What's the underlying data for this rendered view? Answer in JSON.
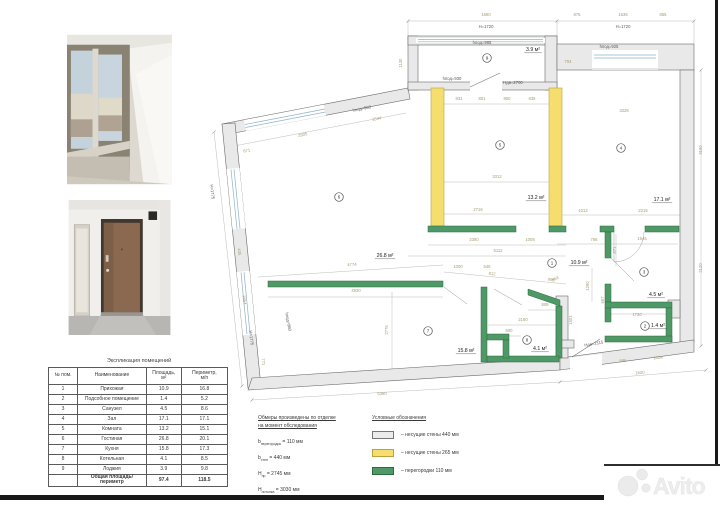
{
  "table": {
    "title": "Экспликация помещений",
    "headers": [
      "№ пом.",
      "Наименование",
      "Площадь,\nм²",
      "Периметр,\nм/п"
    ],
    "rows": [
      [
        "1",
        "Прихожая",
        "10.9",
        "16.8"
      ],
      [
        "2",
        "Подсобное помещение",
        "1.4",
        "5.2"
      ],
      [
        "3",
        "Санузел",
        "4.5",
        "8.6"
      ],
      [
        "4",
        "Зал",
        "17.1",
        "17.1"
      ],
      [
        "5",
        "Комната",
        "13.2",
        "15.1"
      ],
      [
        "6",
        "Гостиная",
        "26.8",
        "20.1"
      ],
      [
        "7",
        "Кухня",
        "15.8",
        "17.3"
      ],
      [
        "8",
        "Котельная",
        "4.1",
        "8.5"
      ],
      [
        "9",
        "Лоджия",
        "3.9",
        "9.8"
      ]
    ],
    "total": {
      "label": "Общая площадь/периметр",
      "area": "97.4",
      "perimeter": "118.5"
    }
  },
  "notes": {
    "line1": "Обмеры произведены по отделке",
    "line2": "на момент обследования",
    "items": [
      {
        "sym": "b",
        "sub": "перегородок",
        "val": "= 110 мм"
      },
      {
        "sym": "b",
        "sub": "стен",
        "val": "= 440 мм"
      },
      {
        "sym": "H",
        "sub": "пр",
        "val": "= 2745 мм"
      },
      {
        "sym": "H",
        "sub": "потолка",
        "val": "= 3030 мм"
      }
    ]
  },
  "legend": {
    "title": "Условные обозначения",
    "items": [
      {
        "color": "#ececec",
        "border": "#777777",
        "label": "– несущие стены 440 мм"
      },
      {
        "color": "#f5dd6e",
        "border": "#b9a33e",
        "label": "– несущие стены 265 мм"
      },
      {
        "color": "#4f9966",
        "border": "#2d6a43",
        "label": "– перегородки 110 мм"
      }
    ]
  },
  "plan": {
    "wall_colors": {
      "bearing_440": "#e9e9e9",
      "bearing_265": "#f5dd6e",
      "partition_110": "#4f9966"
    },
    "rooms": [
      {
        "num": "1",
        "cx": 552,
        "cy": 263,
        "area": "10.9 м²",
        "lx": 579,
        "ly": 264
      },
      {
        "num": "2",
        "cx": 645,
        "cy": 326,
        "area": "1.4 м²",
        "lx": 658,
        "ly": 327
      },
      {
        "num": "3",
        "cx": 644,
        "cy": 272,
        "area": "4.5 м²",
        "lx": 656,
        "ly": 296
      },
      {
        "num": "4",
        "cx": 621,
        "cy": 148,
        "area": "17.1 м²",
        "lx": 662,
        "ly": 201
      },
      {
        "num": "5",
        "cx": 500,
        "cy": 145,
        "area": "13.2 м²",
        "lx": 536,
        "ly": 199
      },
      {
        "num": "6",
        "cx": 339,
        "cy": 197,
        "area": "26.8 м²",
        "lx": 385,
        "ly": 257
      },
      {
        "num": "7",
        "cx": 428,
        "cy": 331,
        "area": "15.8 м²",
        "lx": 466,
        "ly": 352
      },
      {
        "num": "8",
        "cx": 527,
        "cy": 340,
        "area": "4.1 м²",
        "lx": 540,
        "ly": 350
      },
      {
        "num": "9",
        "cx": 487,
        "cy": 58,
        "area": "3.9 м²",
        "lx": 533,
        "ly": 51
      }
    ],
    "dims": [
      {
        "t": "1680",
        "x": 486,
        "y": 16
      },
      {
        "t": "H=1720",
        "x": 486,
        "y": 28,
        "d": 1
      },
      {
        "t": "hпод=965",
        "x": 482,
        "y": 44,
        "d": 1
      },
      {
        "t": "1130",
        "x": 402,
        "y": 63,
        "r": -90
      },
      {
        "t": "704",
        "x": 568,
        "y": 63
      },
      {
        "t": "875",
        "x": 577,
        "y": 16
      },
      {
        "t": "1636",
        "x": 623,
        "y": 16
      },
      {
        "t": "855",
        "x": 663,
        "y": 16
      },
      {
        "t": "H=1720",
        "x": 623,
        "y": 28,
        "d": 1
      },
      {
        "t": "hпод=925",
        "x": 609,
        "y": 48,
        "d": 1
      },
      {
        "t": "3326",
        "x": 624,
        "y": 112
      },
      {
        "t": "3190",
        "x": 702,
        "y": 150,
        "r": -90
      },
      {
        "t": "2120",
        "x": 702,
        "y": 268,
        "r": -90
      },
      {
        "t": "hпод=930",
        "x": 452,
        "y": 80,
        "d": 1
      },
      {
        "t": "Hдв=2700",
        "x": 513,
        "y": 84,
        "d": 1
      },
      {
        "t": "831",
        "x": 459,
        "y": 100
      },
      {
        "t": "801",
        "x": 482,
        "y": 100
      },
      {
        "t": "850",
        "x": 507,
        "y": 100
      },
      {
        "t": "835",
        "x": 532,
        "y": 100
      },
      {
        "t": "3312",
        "x": 497,
        "y": 178
      },
      {
        "t": "2716",
        "x": 478,
        "y": 211
      },
      {
        "t": "2380",
        "x": 474,
        "y": 241
      },
      {
        "t": "1009",
        "x": 530,
        "y": 241
      },
      {
        "t": "5112",
        "x": 498,
        "y": 252
      },
      {
        "t": "1000",
        "x": 458,
        "y": 268
      },
      {
        "t": "545",
        "x": 487,
        "y": 268
      },
      {
        "t": "812",
        "x": 492,
        "y": 275,
        "r": 6
      },
      {
        "t": "958",
        "x": 551,
        "y": 281,
        "r": 6
      },
      {
        "t": "2805",
        "x": 303,
        "y": 136,
        "r": -11
      },
      {
        "t": "671",
        "x": 247,
        "y": 152,
        "r": -11
      },
      {
        "t": "hпод=960",
        "x": 362,
        "y": 110,
        "r": -11,
        "d": 1
      },
      {
        "t": "1544",
        "x": 377,
        "y": 120,
        "r": -11
      },
      {
        "t": "H=1775",
        "x": 211,
        "y": 192,
        "r": 84,
        "d": 1
      },
      {
        "t": "435",
        "x": 238,
        "y": 252,
        "r": 84
      },
      {
        "t": "2864",
        "x": 243,
        "y": 300,
        "r": 84
      },
      {
        "t": "H=1775",
        "x": 250,
        "y": 338,
        "r": 84,
        "d": 1
      },
      {
        "t": "hпод=960",
        "x": 287,
        "y": 322,
        "r": 80,
        "d": 1
      },
      {
        "t": "771",
        "x": 262,
        "y": 362,
        "r": 84
      },
      {
        "t": "4774",
        "x": 352,
        "y": 266,
        "r": -3
      },
      {
        "t": "4930",
        "x": 356,
        "y": 292
      },
      {
        "t": "2776",
        "x": 388,
        "y": 330,
        "r": -90
      },
      {
        "t": "5360",
        "x": 382,
        "y": 395,
        "r": -3
      },
      {
        "t": "2160",
        "x": 523,
        "y": 321
      },
      {
        "t": "500",
        "x": 509,
        "y": 332
      },
      {
        "t": "809",
        "x": 545,
        "y": 306
      },
      {
        "t": "1501",
        "x": 572,
        "y": 320,
        "r": -90
      },
      {
        "t": "1012",
        "x": 583,
        "y": 212
      },
      {
        "t": "2215",
        "x": 643,
        "y": 212
      },
      {
        "t": "766",
        "x": 594,
        "y": 241
      },
      {
        "t": "1945",
        "x": 642,
        "y": 240
      },
      {
        "t": "871",
        "x": 616,
        "y": 250,
        "r": -90
      },
      {
        "t": "863",
        "x": 556,
        "y": 280,
        "r": -28
      },
      {
        "t": "1290",
        "x": 589,
        "y": 286,
        "r": -90
      },
      {
        "t": "667",
        "x": 604,
        "y": 300,
        "r": -90
      },
      {
        "t": "1730",
        "x": 637,
        "y": 316
      },
      {
        "t": "Hдв=2115",
        "x": 594,
        "y": 345,
        "r": -10,
        "d": 1
      },
      {
        "t": "586",
        "x": 623,
        "y": 362,
        "r": -4
      },
      {
        "t": "1024",
        "x": 658,
        "y": 359,
        "r": -4
      },
      {
        "t": "1620",
        "x": 640,
        "y": 374,
        "r": -4
      }
    ]
  },
  "watermark": {
    "text": "Avito"
  }
}
